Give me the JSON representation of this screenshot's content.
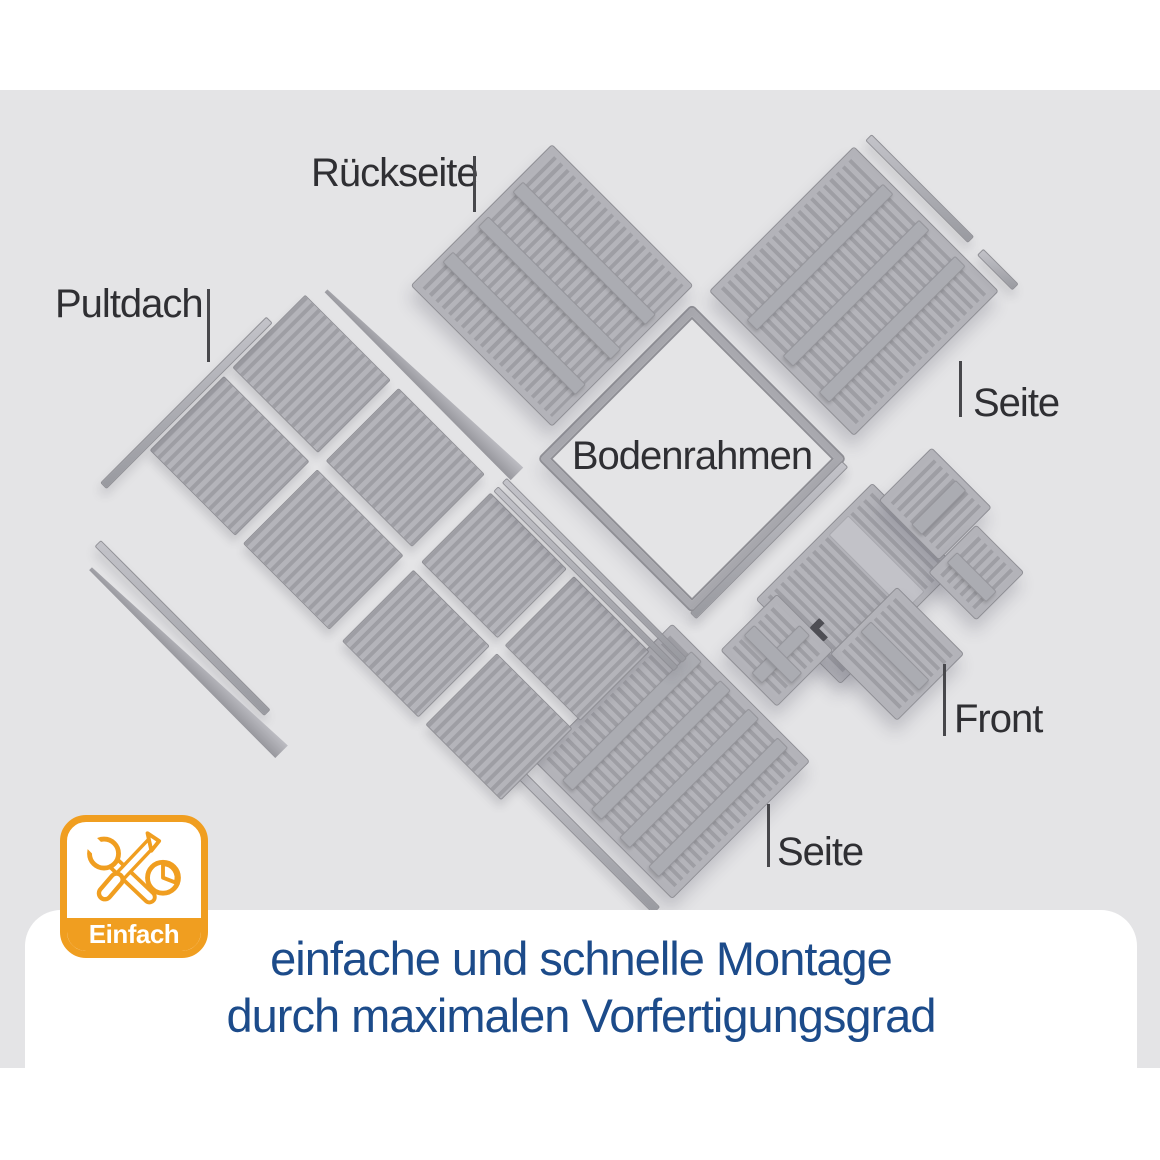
{
  "scene": {
    "background_color": "#e4e4e6",
    "part_labels": {
      "rueckseite": "Rückseite",
      "pultdach": "Pultdach",
      "seite_right": "Seite",
      "bodenrahmen": "Bodenrahmen",
      "front": "Front",
      "seite_bottom": "Seite"
    }
  },
  "badge": {
    "label": "Einfach",
    "accent_color": "#F09E20",
    "icons": [
      "wrench-icon",
      "screwdriver-icon",
      "clock-icon"
    ]
  },
  "caption": {
    "line1": "einfache und schnelle Montage",
    "line2": "durch maximalen Vorfertigungsgrad",
    "text_color": "#1C4B8A"
  },
  "colors": {
    "panel_gray": "#ABABB1",
    "label_text": "#2F2F33",
    "background_white": "#FFFFFF"
  }
}
